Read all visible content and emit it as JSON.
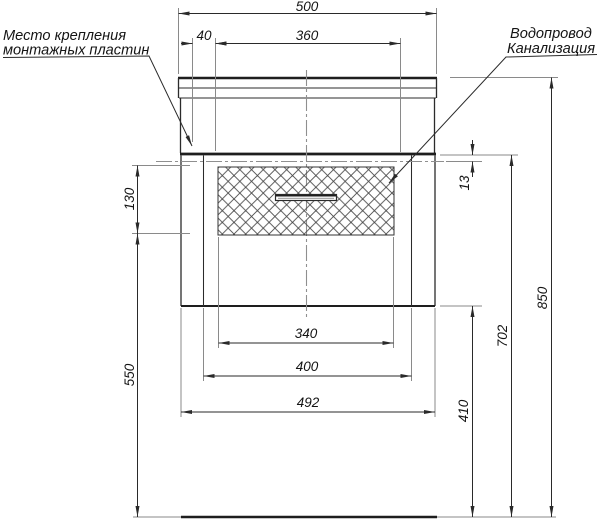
{
  "page": {
    "background": "#ffffff"
  },
  "drawing": {
    "type": "installation-technical-drawing",
    "view": "vanity-cabinet-front",
    "labels": {
      "mounting_line1": "Место крепления",
      "mounting_line2": "монтажных пластин",
      "utilities_line1": "Водопровод",
      "utilities_line2": "Канализация"
    },
    "dimensions": {
      "overall_width": "500",
      "plate_offset_x": "40",
      "plate_span": "360",
      "drawer_front_height": "130",
      "plate_offset_y": "13",
      "floor_clearance": "550",
      "drawer_front_width": "340",
      "opening_width": "400",
      "cabinet_width": "492",
      "cabinet_bottom_height": "410",
      "plate_line_height": "702",
      "overall_height": "850"
    },
    "colors": {
      "background": "#ffffff",
      "outline": "#2b2b2b",
      "extension_line": "#8a8a8a",
      "hatch": "#4a4a4a",
      "text": "#141414"
    }
  }
}
